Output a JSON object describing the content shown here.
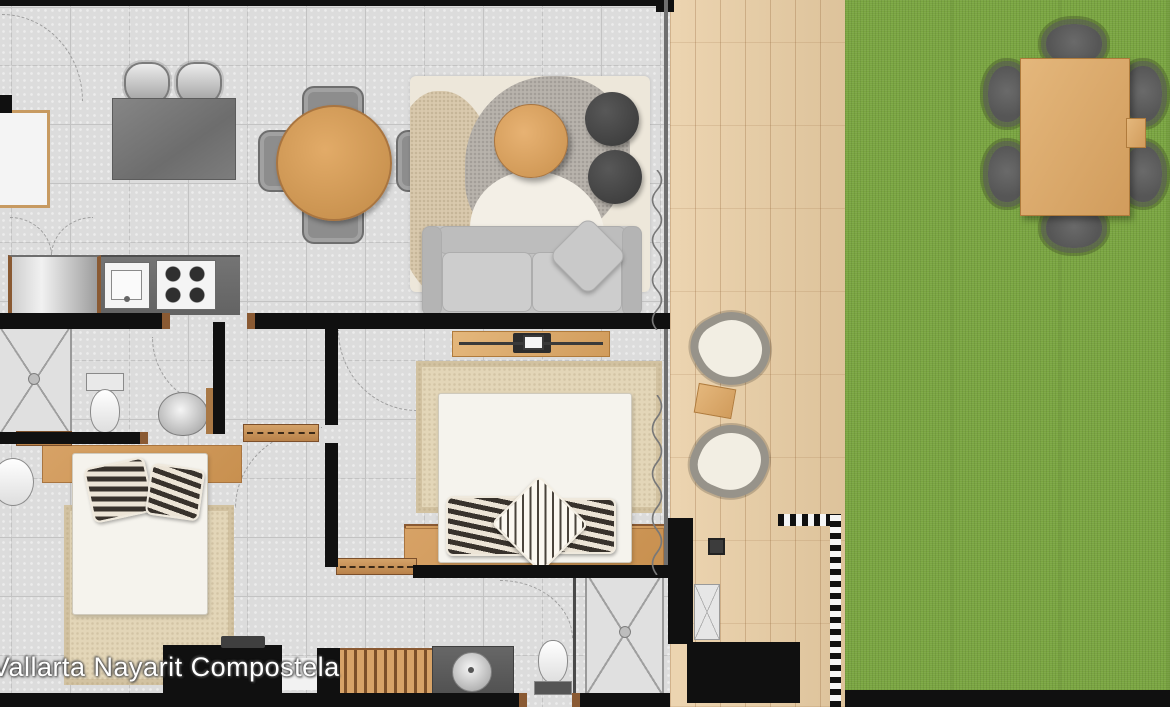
{
  "watermark": {
    "text": "Vallarta Nayarit Compostela"
  },
  "palette": {
    "wall": "#101010",
    "floor": "#dcdcdc",
    "tile_line": "#c3c3c3",
    "deck": "#e9cda3",
    "grass": "#79a540",
    "wood": "#d7a266",
    "wood_dark": "#8a5a33",
    "counter": "#696969",
    "sofa": "#c2c2c2",
    "pouf": "#4b4b4b",
    "bed": "#f5f3ed",
    "rug_cream": "#ede7da",
    "rug_beige": "#e3d6b8",
    "pillow_dark": "#38322c",
    "watermark_color": "#ffffff"
  },
  "elements": {
    "areas": [
      "kitchen",
      "dining-area",
      "living-room",
      "bathroom",
      "hallway",
      "bedroom",
      "second-bedroom",
      "second-bathroom",
      "wood-deck",
      "lawn"
    ],
    "furniture": [
      "kitchen-island",
      "bar-stools",
      "kitchen-counter",
      "kitchen-sink",
      "gas-stove",
      "refrigerator",
      "round-dining-table",
      "dining-chairs",
      "tv-console",
      "area-rug",
      "round-coffee-table",
      "ottoman-poufs",
      "sofa",
      "throw-pillow",
      "shower",
      "toilet",
      "washbasin",
      "double-bed",
      "striped-pillows",
      "wood-headboard",
      "nightstands",
      "slatted-dresser",
      "wardrobe",
      "vanity-with-round-sink",
      "wicker-lounge-chairs",
      "deck-side-table",
      "outdoor-dining-table",
      "outdoor-chairs",
      "curtain-symbols",
      "door-swing-arcs"
    ]
  }
}
